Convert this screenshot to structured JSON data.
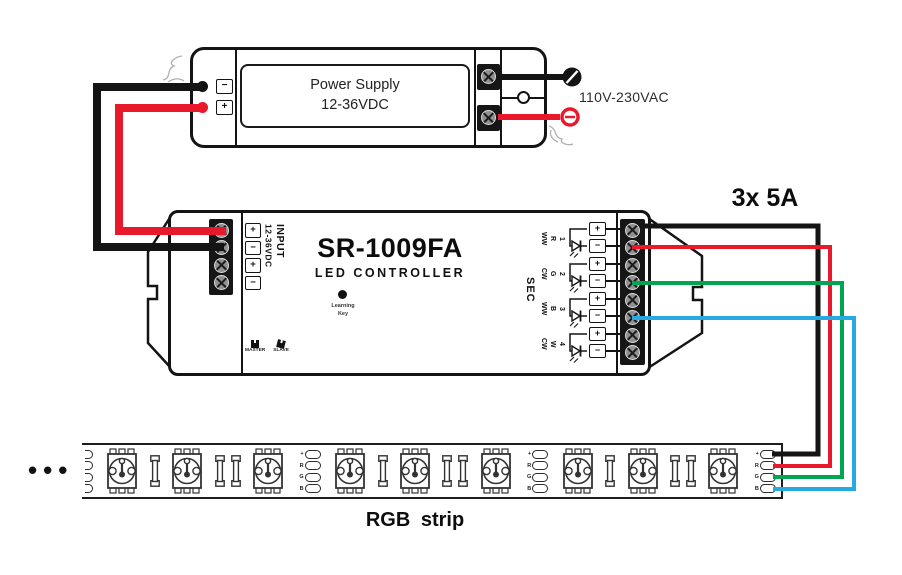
{
  "colors": {
    "black": "#141414",
    "red": "#e8192b",
    "green": "#00a551",
    "blue": "#27a9e1",
    "sketch": "#b0b0b0"
  },
  "power_supply": {
    "label_line1": "Power Supply",
    "label_line2": "12-36VDC",
    "terminal_minus": "−",
    "terminal_plus": "+",
    "ac_label": "110V-230VAC"
  },
  "controller": {
    "model": "SR-1009FA",
    "subtitle": "LED CONTROLLER",
    "input_label": "INPUT",
    "input_voltage": "12-36VDC",
    "input_terminals": [
      "+",
      "−",
      "+",
      "−"
    ],
    "plus": "+",
    "minus": "−",
    "learning_key_line1": "Learning",
    "learning_key_line2": "Key",
    "master_label": "MASTER",
    "slave_label": "SLAVE",
    "sec_label": "SEC",
    "channels": [
      {
        "type": "WW",
        "letter": "R",
        "number": "1"
      },
      {
        "type": "CW",
        "letter": "G",
        "number": "2"
      },
      {
        "type": "WW",
        "letter": "B",
        "number": "3"
      },
      {
        "type": "CW",
        "letter": "W",
        "number": "4"
      }
    ]
  },
  "output_rating": "3x 5A",
  "strip": {
    "label": "RGB strip",
    "continuation_dots": "•••",
    "pad_labels": [
      "+",
      "R",
      "G",
      "B"
    ],
    "pattern": [
      "cut-pads",
      "led",
      "res1",
      "led",
      "res2",
      "led",
      "pads",
      "led",
      "res1",
      "led",
      "res2",
      "led",
      "pads",
      "led",
      "res1",
      "led",
      "res2",
      "led",
      "end-pads"
    ]
  }
}
